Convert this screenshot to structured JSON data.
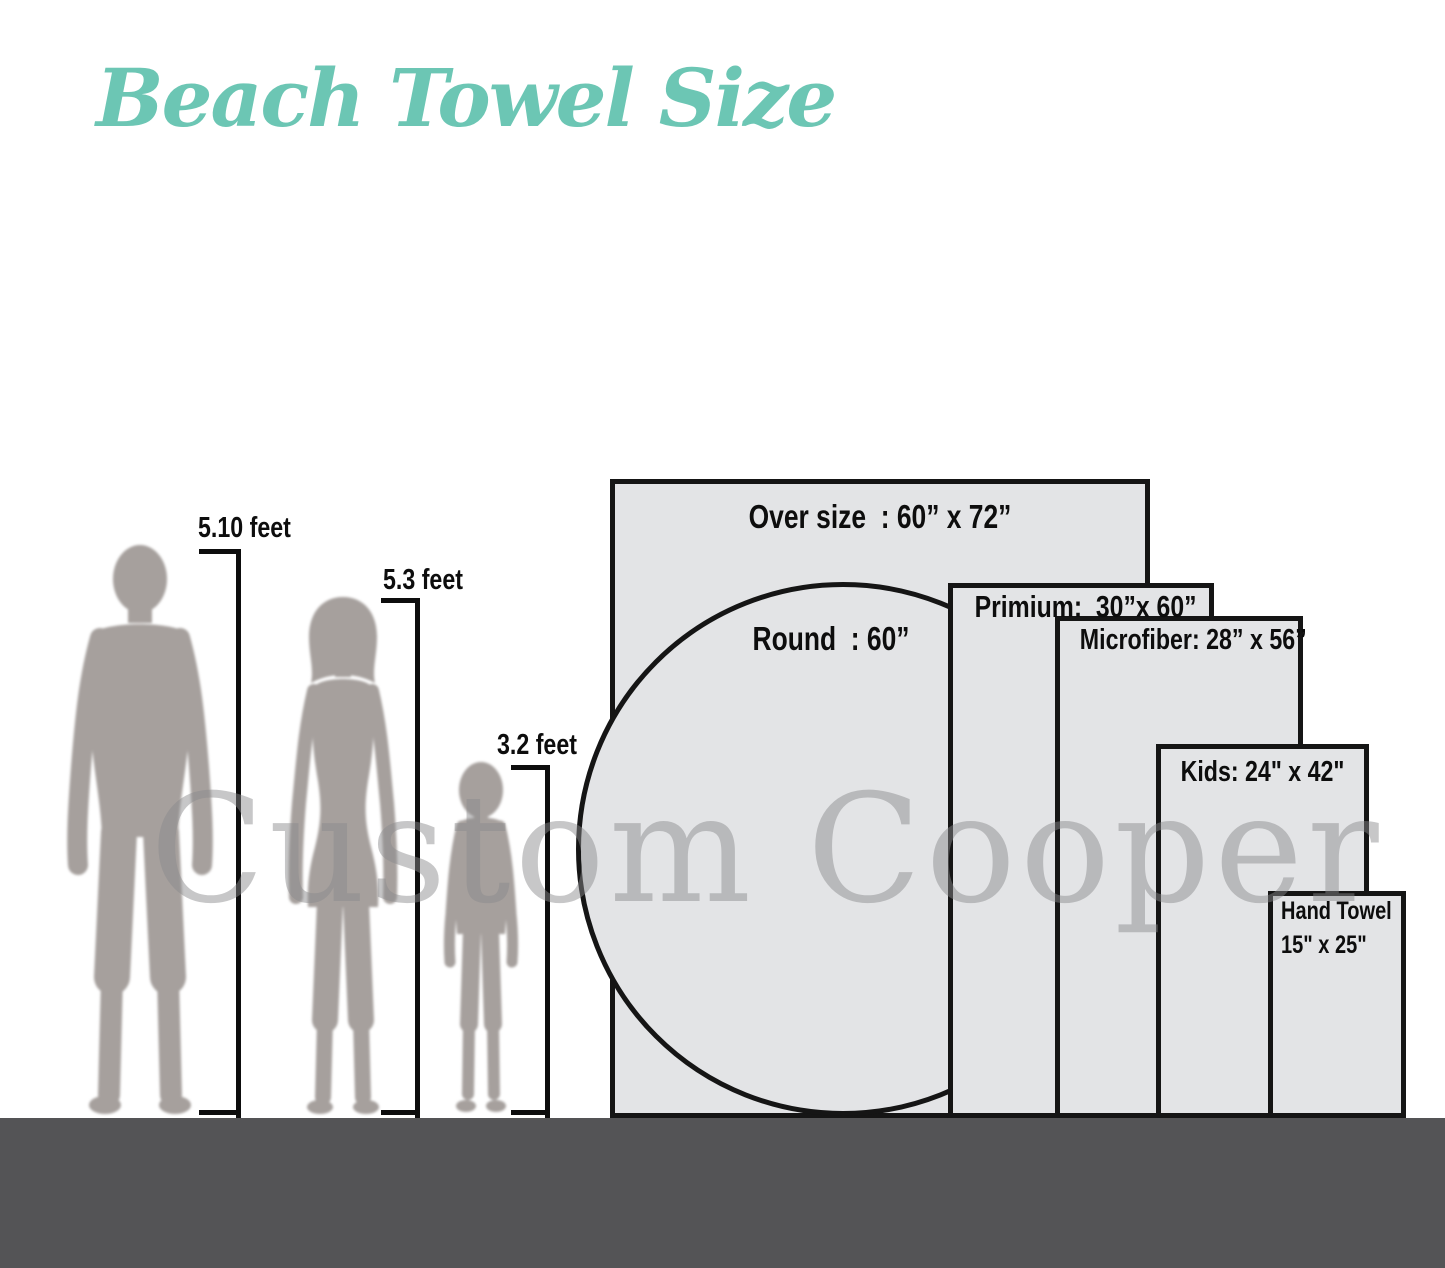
{
  "title": "Beach Towel Size",
  "watermark": "Custom Cooper",
  "figures": [
    {
      "name": "man",
      "height_label": "5.10 feet"
    },
    {
      "name": "woman",
      "height_label": "5.3 feet"
    },
    {
      "name": "child",
      "height_label": "3.2 feet"
    }
  ],
  "towels": [
    {
      "name": "oversize",
      "shape": "rect",
      "label": "Over size  : 60” x 72”"
    },
    {
      "name": "round",
      "shape": "circle",
      "label": "Round  : 60”"
    },
    {
      "name": "premium",
      "shape": "rect",
      "label": "Primium:  30”x 60”"
    },
    {
      "name": "microfiber",
      "shape": "rect",
      "label": "Microfiber: 28” x 56”"
    },
    {
      "name": "kids",
      "shape": "rect",
      "label": "Kids: 24\" x 42\""
    },
    {
      "name": "hand_towel",
      "shape": "rect",
      "label_line1": "Hand Towel",
      "label_line2": "15\" x 25\""
    }
  ],
  "colors": {
    "title": "#6cc6b4",
    "towel_fill": "#e3e4e6",
    "towel_border": "#151515",
    "ground": "#545456",
    "silhouette": "#a6a09d",
    "watermark": "#8a8a8d"
  }
}
